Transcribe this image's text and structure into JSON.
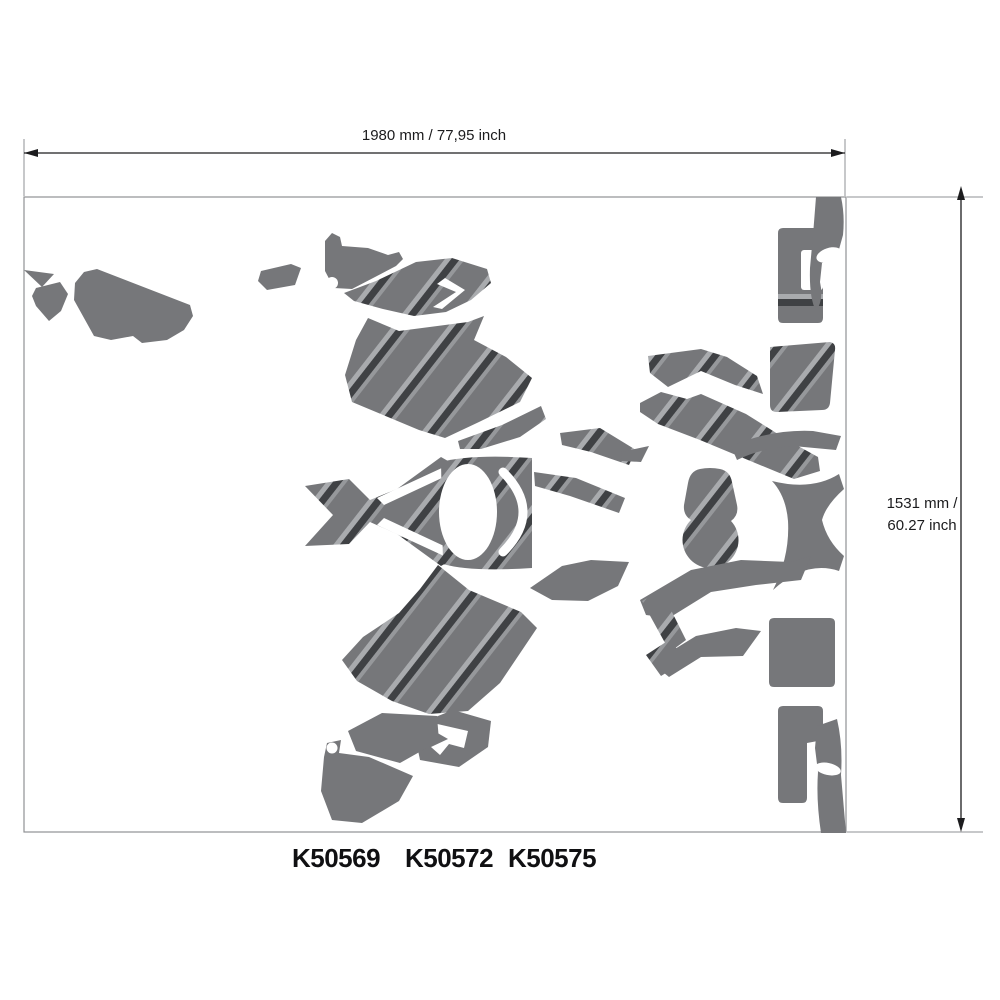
{
  "diagram": {
    "title_hint": "decal-sheet-layout",
    "dimensions": {
      "width_label": "1980 mm / 77,95 inch",
      "height_label_line1": "1531 mm /",
      "height_label_line2": "60.27 inch"
    },
    "part_numbers": [
      "K50569",
      "K50572",
      "K50575"
    ],
    "colors": {
      "decal-gray": "#76777a",
      "stripe-light": "#a9abae",
      "stripe-mid": "#96989b",
      "stripe-dark": "#3f4144",
      "dimension-line": "#1c1c1e",
      "frame-line": "#8f9194",
      "background": "#ffffff"
    }
  }
}
